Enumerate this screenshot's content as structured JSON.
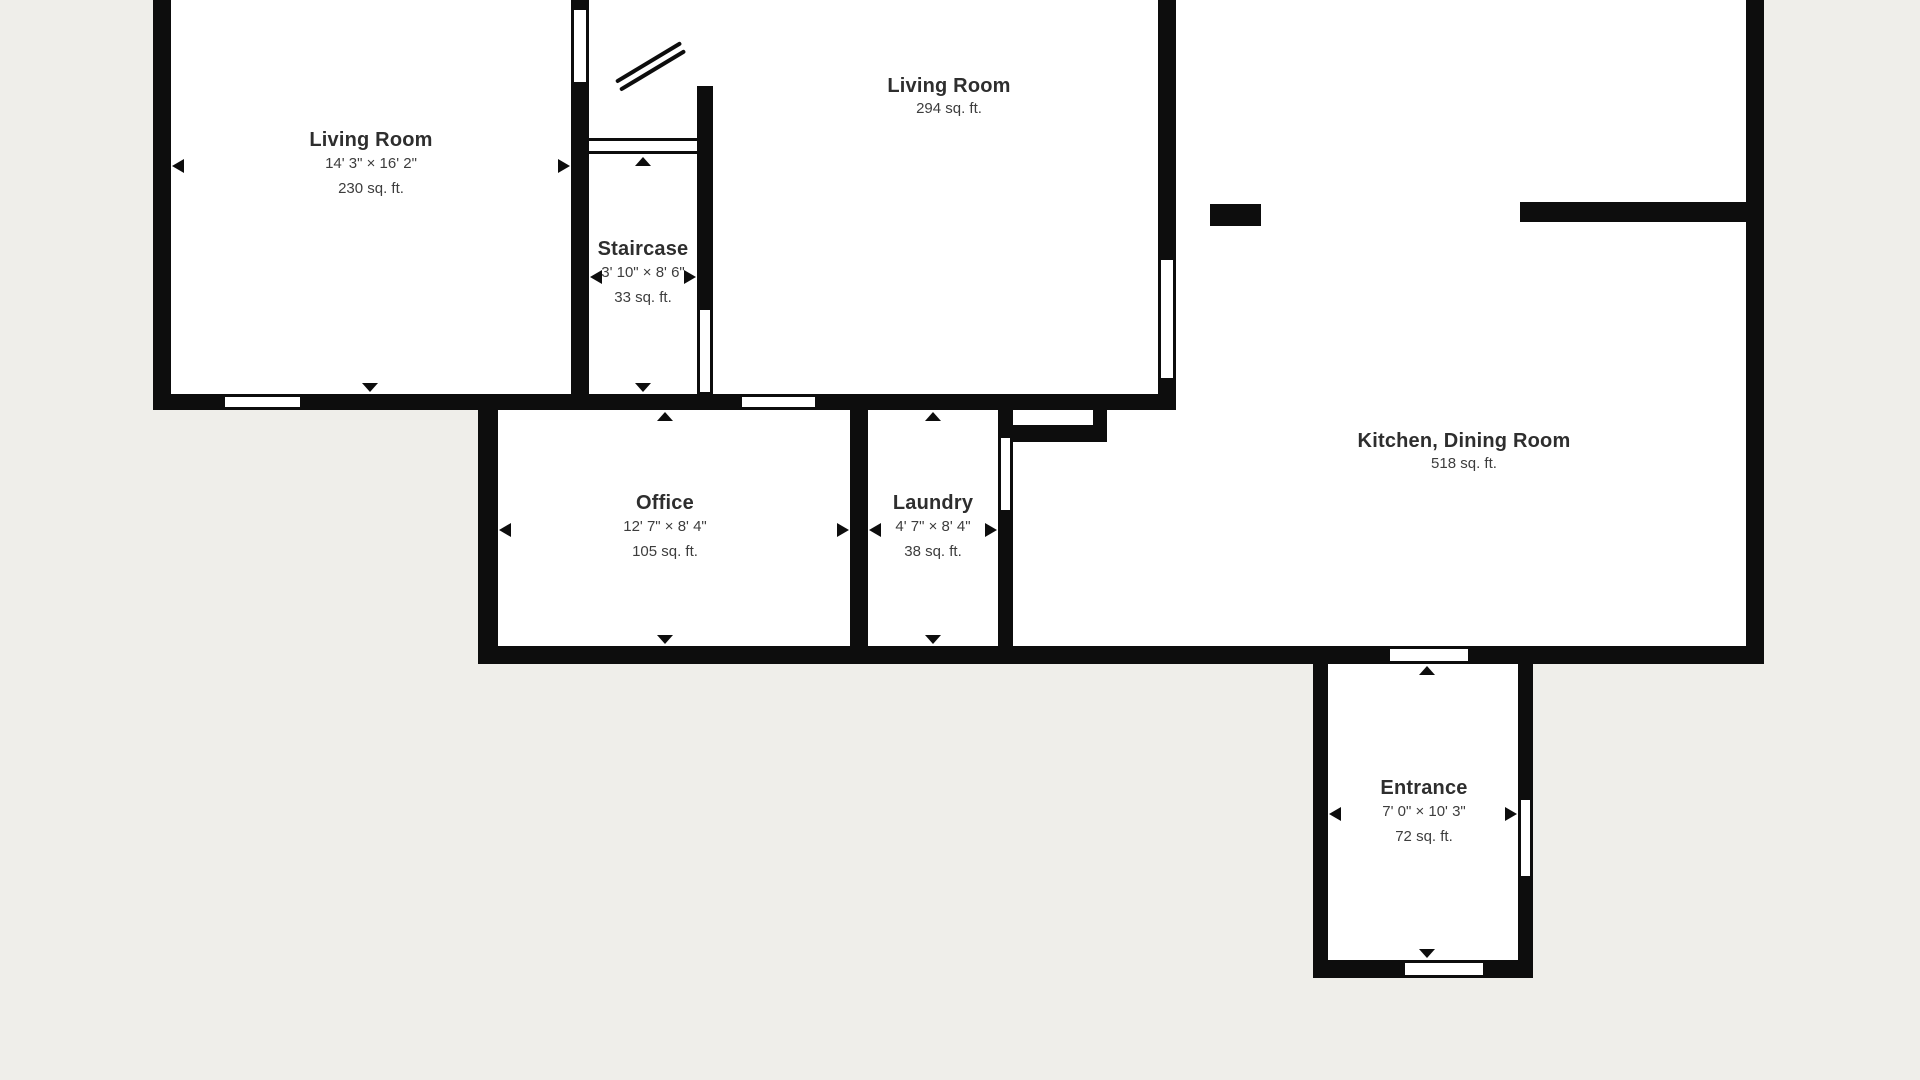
{
  "title": "Floor plan",
  "rooms": {
    "living_room_1": {
      "name": "Living Room",
      "dimensions": "14' 3\" × 16' 2\"",
      "area": "230 sq. ft."
    },
    "staircase": {
      "name": "Staircase",
      "dimensions": "3' 10\" × 8' 6\"",
      "area": "33 sq. ft."
    },
    "living_room_2": {
      "name": "Living Room",
      "area": "294 sq. ft."
    },
    "kitchen_dining": {
      "name": "Kitchen, Dining Room",
      "area": "518 sq. ft."
    },
    "office": {
      "name": "Office",
      "dimensions": "12' 7\" × 8' 4\"",
      "area": "105 sq. ft."
    },
    "laundry": {
      "name": "Laundry",
      "dimensions": "4' 7\" × 8' 4\"",
      "area": "38 sq. ft."
    },
    "entrance": {
      "name": "Entrance",
      "dimensions": "7' 0\" × 10' 3\"",
      "area": "72 sq. ft."
    }
  },
  "colors": {
    "wall": "#0d0d0d",
    "floor": "#ffffff",
    "background": "#efeeea",
    "text": "#2e2e2e",
    "subtext": "#3d3d3d"
  }
}
